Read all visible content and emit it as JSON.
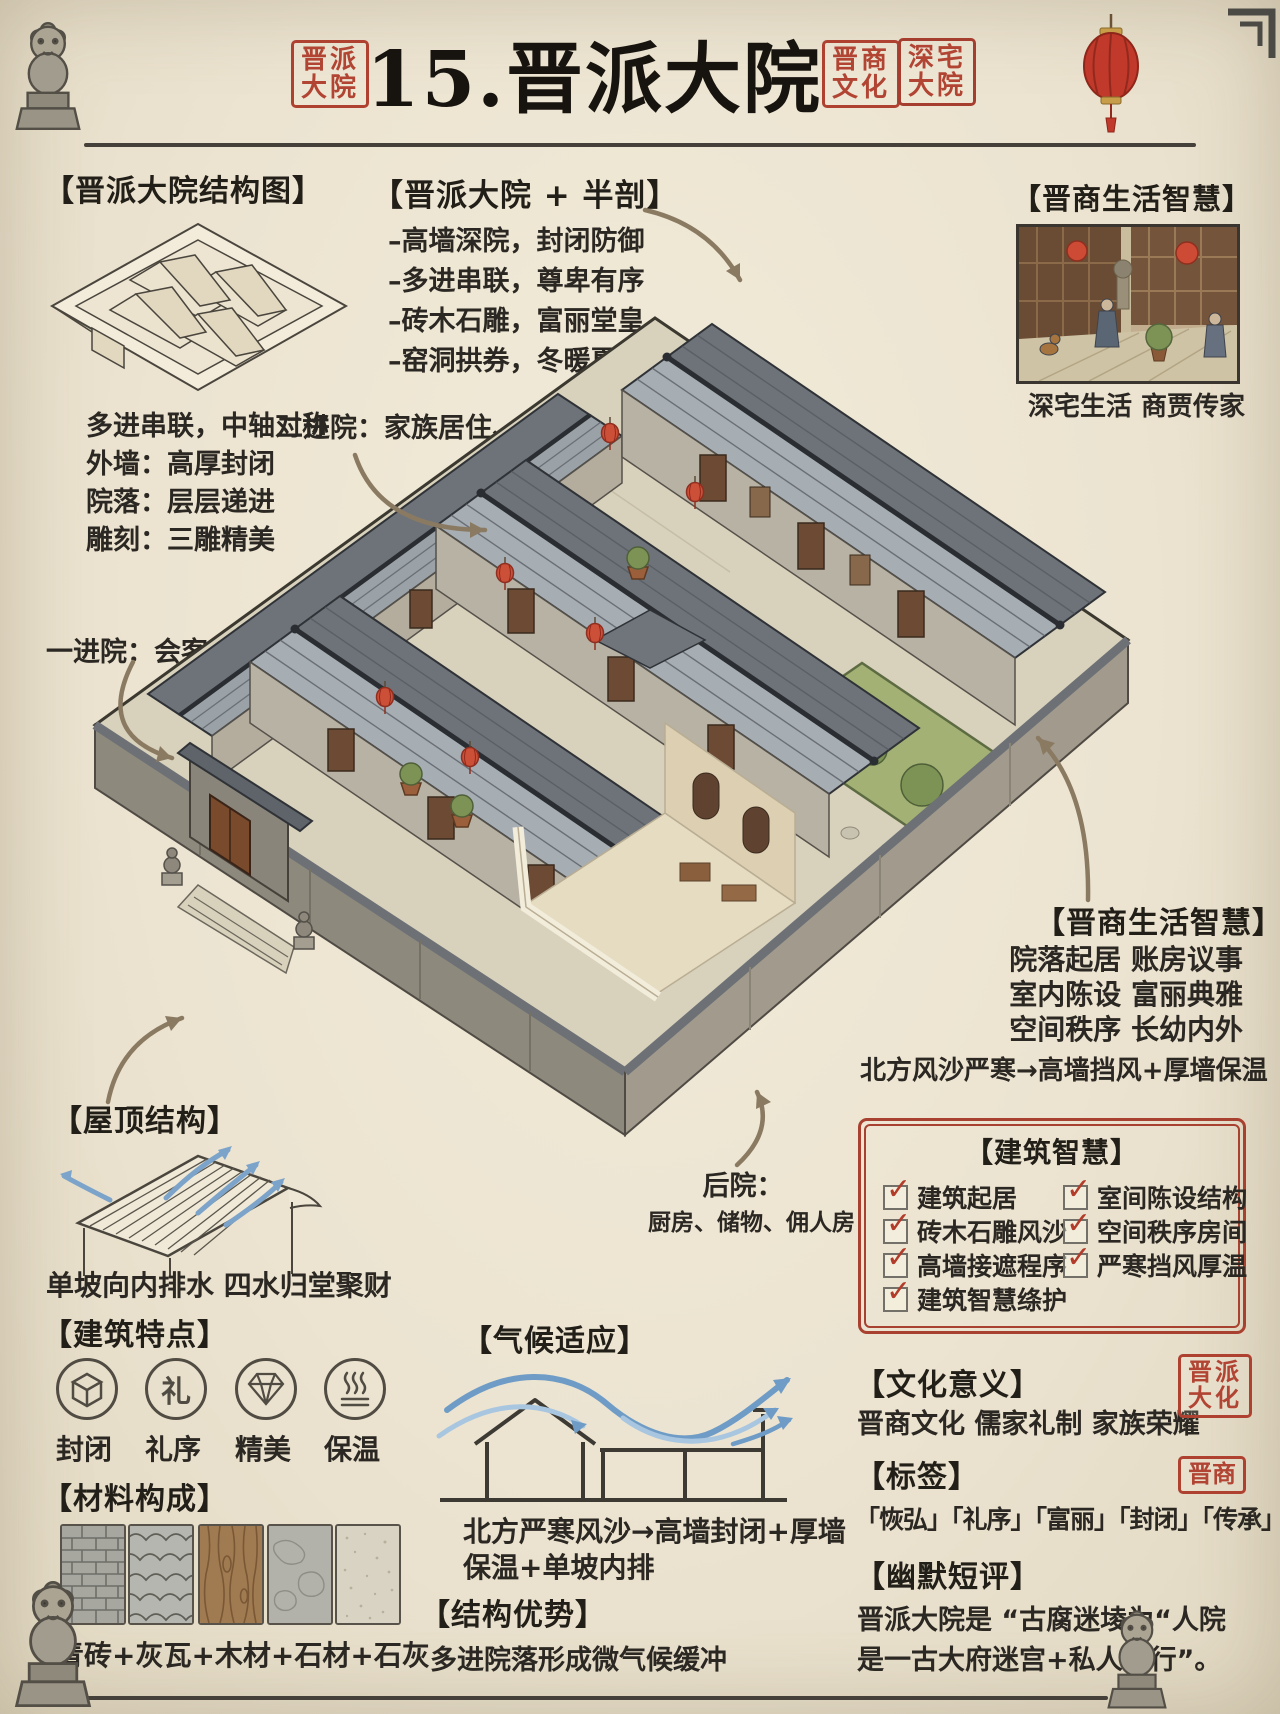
{
  "icons": {
    "check": "✓",
    "li": "礼"
  },
  "header": {
    "seal_left": [
      "晋派",
      "大院"
    ],
    "title": "15.晋派大院",
    "seal_right1": [
      "晋商",
      "文化"
    ],
    "seal_right2": [
      "深宅",
      "大院"
    ]
  },
  "structure": {
    "heading": "【晋派大院结构图】",
    "lines": [
      "多进串联，中轴对称",
      "外墙：高厚封闭",
      "院落：层层递进",
      "雕刻：三雕精美"
    ]
  },
  "halfcut": {
    "heading": "【晋派大院 + 半剖】",
    "bullets": [
      "–高墙深院，封闭防御",
      "–多进串联，尊卑有序",
      "–砖木石雕，富丽堂皇",
      "–窑洞拱券，冬暖夏凉"
    ]
  },
  "life_top": {
    "heading": "【晋商生活智慧】",
    "caption": "深宅生活 商贾传家"
  },
  "callouts": {
    "second": "二进院：家族居住、长辈",
    "first": "一进院：会客、客房、服务",
    "back_title": "后院：",
    "back_sub": "厨房、储物、佣人房"
  },
  "life_right": {
    "heading": "【晋商生活智慧】",
    "lines": [
      "院落起居 账房议事",
      "室内陈设 富丽典雅",
      "空间秩序 长幼内外"
    ],
    "line4": "北方风沙严寒→高墙挡风+厚墙保温"
  },
  "wisdom": {
    "heading": "【建筑智慧】",
    "left": [
      "建筑起居",
      "砖木石雕风沙",
      "高墙接遮程序",
      "建筑智慧绦护"
    ],
    "right": [
      "室间陈设结构",
      "空间秩序房间",
      "严寒挡风厚温"
    ]
  },
  "roof": {
    "heading": "【屋顶结构】",
    "caption": "单坡向内排水 四水归堂聚财"
  },
  "features": {
    "heading": "【建筑特点】",
    "labels": [
      "封闭",
      "礼序",
      "精美",
      "保温"
    ]
  },
  "materials": {
    "heading": "【材料构成】",
    "caption": "青砖+灰瓦+木材+石材+石灰"
  },
  "climate": {
    "heading": "【气候适应】",
    "line1": "北方严寒风沙→高墙封闭+厚墙",
    "line2": "保温+单坡内排"
  },
  "advantage": {
    "heading": "【结构优势】",
    "text": "多进院落形成微气候缓冲"
  },
  "culture": {
    "heading": "【文化意义】",
    "text": "晋商文化 儒家礼制 家族荣耀",
    "seal": [
      "晋派",
      "大化"
    ]
  },
  "tags": {
    "heading": "【标签】",
    "text": "「恢弘」「礼序」「富丽」「封闭」「传承」",
    "seal": "晋商"
  },
  "humor": {
    "heading": "【幽默短评】",
    "line1": "晋派大院是 “古腐迷堎为“人院",
    "line2": "是一古大府迷宫+私人银行”。"
  }
}
